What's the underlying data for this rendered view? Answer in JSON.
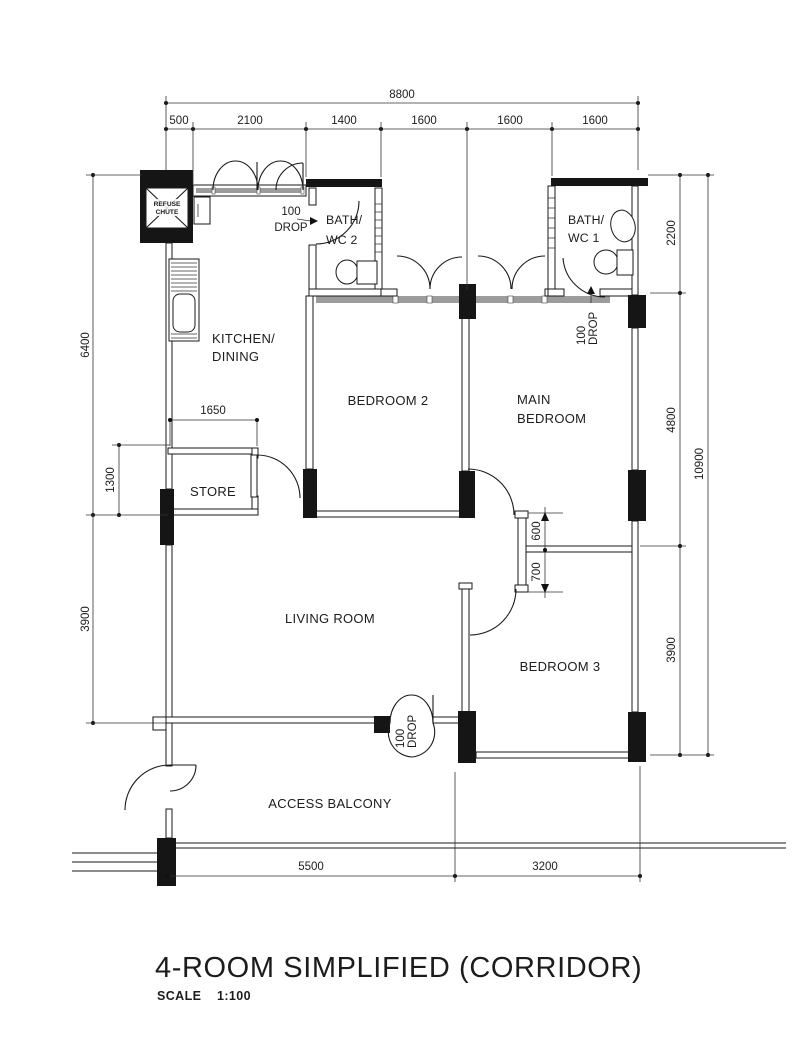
{
  "title": {
    "main": "4-ROOM SIMPLIFIED (CORRIDOR)",
    "scale_label": "SCALE",
    "scale_value": "1:100"
  },
  "rooms": {
    "refuse": {
      "line1": "REFUSE",
      "line2": "CHUTE"
    },
    "kitchen": {
      "line1": "KITCHEN/",
      "line2": "DINING"
    },
    "bath2": {
      "line1": "BATH/",
      "line2": "WC 2"
    },
    "bath1": {
      "line1": "BATH/",
      "line2": "WC 1"
    },
    "bedroom2": "BEDROOM 2",
    "main_bedroom": {
      "line1": "MAIN",
      "line2": "BEDROOM"
    },
    "bedroom3": "BEDROOM 3",
    "store": "STORE",
    "living": "LIVING ROOM",
    "balcony": "ACCESS BALCONY"
  },
  "dimensions": {
    "top_total": "8800",
    "top_segments": [
      "500",
      "2100",
      "1400",
      "1600",
      "1600",
      "1600"
    ],
    "left_upper": "6400",
    "left_store": "1300",
    "left_lower": "3900",
    "right_top": "2200",
    "right_mid": "4800",
    "right_low": "3900",
    "right_total": "10900",
    "store_width": "1650",
    "door_upper": "600",
    "door_lower": "700",
    "bottom_left": "5500",
    "bottom_right": "3200"
  },
  "annotations": {
    "drop_kitchen": {
      "line1": "100",
      "line2": "DROP"
    },
    "drop_bath1": {
      "line1": "100",
      "line2": "DROP"
    },
    "drop_living": {
      "line1": "100",
      "line2": "DROP"
    }
  }
}
